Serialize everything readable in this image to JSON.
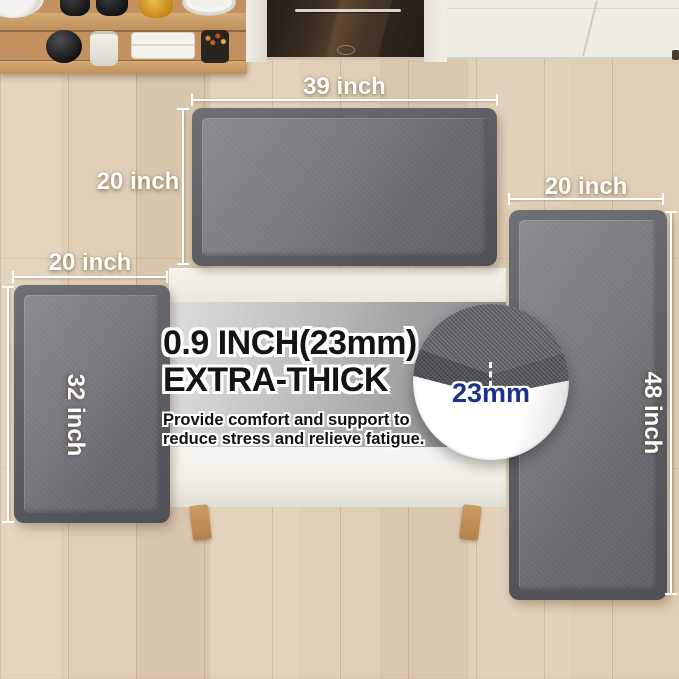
{
  "dimensions": {
    "top_mat": {
      "width_label": "39 inch",
      "height_label": "20 inch"
    },
    "left_mat": {
      "width_label": "20 inch",
      "height_label": "32 inch"
    },
    "right_mat": {
      "width_label": "20 inch",
      "height_label": "48 inch"
    }
  },
  "feature": {
    "headline_line1": "0.9 INCH(23mm)",
    "headline_line2": "EXTRA-THICK",
    "subtext_line1": "Provide comfort and support to",
    "subtext_line2": "reduce stress and relieve fatigue.",
    "thickness_callout": "23mm"
  },
  "colors": {
    "mat_surface_gray": "#6e7074",
    "mat_edge_gray": "#54565a",
    "floor_wood": "#e0cfb6",
    "callout_blue": "#1c3188",
    "dimension_label_white": "#ffffff",
    "headline_black": "#141414"
  }
}
